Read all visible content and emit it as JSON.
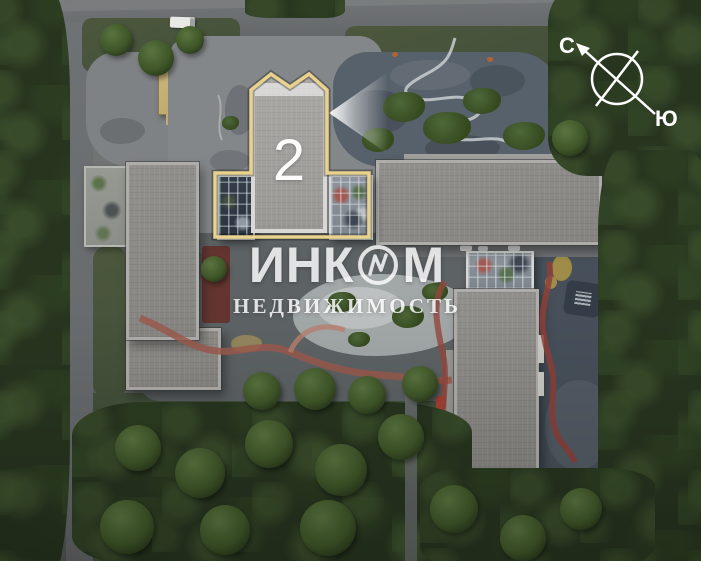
{
  "plan": {
    "building_marker": {
      "label": "2"
    },
    "compass": {
      "north_label": "С",
      "south_label": "Ю"
    },
    "watermark": {
      "brand_full": "ИНКОМ",
      "brand_left": "ИНК",
      "brand_right": "М",
      "subtitle": "НЕДВИЖИМОСТЬ"
    },
    "colors": {
      "highlight_outline": "#e9d28b",
      "building_roof": "#9a9996",
      "accent_path_red": "#95473d",
      "watermark_text": "#ffffff"
    }
  }
}
